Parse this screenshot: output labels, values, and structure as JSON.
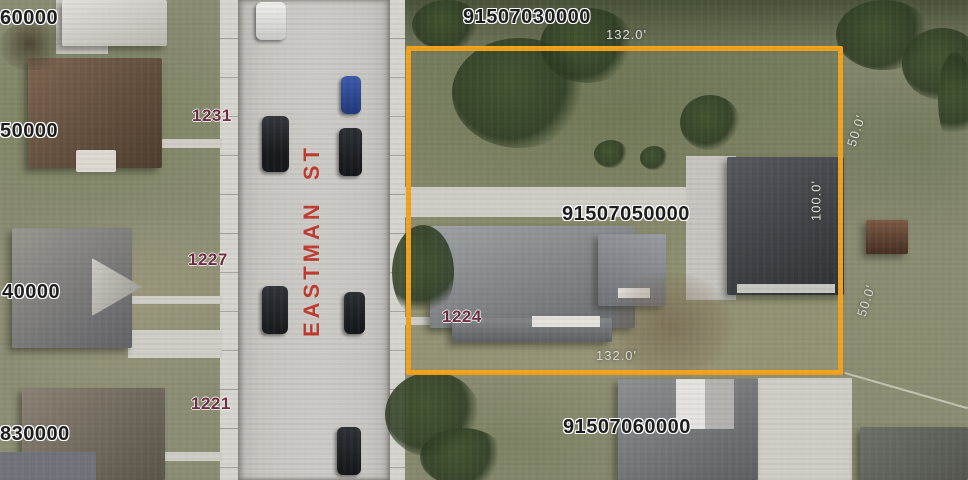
{
  "map": {
    "view_type": "aerial-parcel-view",
    "street_label": "EASTMAN ST",
    "parcel_ids": {
      "top": "91507030000",
      "selected": "91507050000",
      "bottom": "91507060000"
    },
    "partial_parcel_ids": {
      "left_top": "60000",
      "left_upper": "50000",
      "left_lower": "40000",
      "left_bottom": "830000"
    },
    "house_numbers": [
      "1231",
      "1227",
      "1221",
      "1224"
    ],
    "dimensions": {
      "top_width": "132.0'",
      "bottom_width": "132.0'",
      "east_depth": "100.0'",
      "northeast_side": "50.0'",
      "southeast_side": "50.0'"
    },
    "colors": {
      "selected_parcel_outline": "#F2A21B",
      "parcel_id_text": "#1B1B1B",
      "house_number_text": "#6D2A40",
      "street_label_text": "#BF3B2F",
      "dimension_text": "#DADBD6"
    }
  }
}
